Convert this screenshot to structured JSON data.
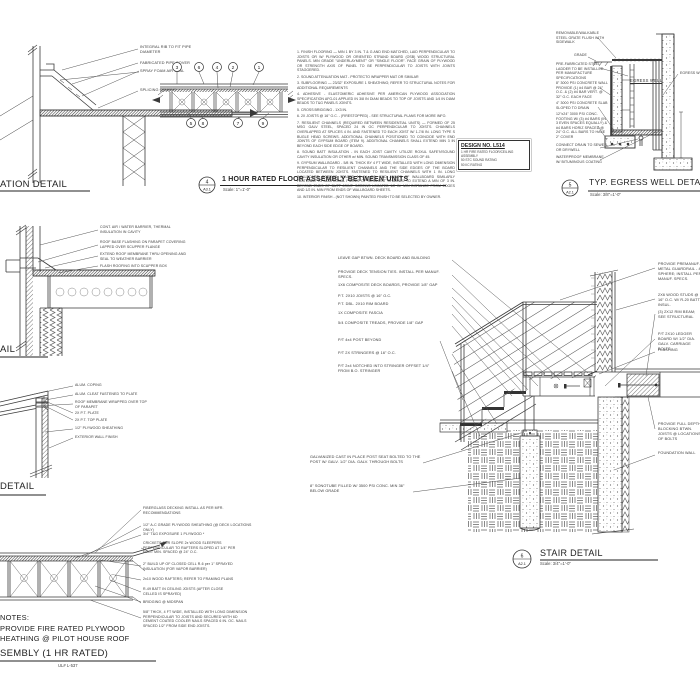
{
  "sheet": {
    "background": "#ffffff",
    "line_color": "#3a3a3a"
  },
  "details": {
    "pipe": {
      "title": "ATION DETAIL",
      "labels": [
        "INTEGRAL RIB TO FIT PIPE DIAMETER",
        "FABRICATED PIPE COVER",
        "SPRAY FOAM AIR SEAL",
        "SPLICING CEMENT"
      ]
    },
    "floor": {
      "num": "4",
      "ref": "A3.1",
      "title": "1 HOUR RATED FLOOR ASSEMBLY BETWEEN UNITS",
      "scale": "Scale: 1\"=1'-0\"",
      "callouts": [
        "3",
        "6",
        "4",
        "2",
        "1",
        "5",
        "8",
        "7",
        "9"
      ],
      "notes": [
        "1. FINISH FLOORING — MIN 1 BY 3 IN. T & G AND END MATCHED, LAID PERPENDICULAR TO JOISTS OR W/ PLYWOOD OR ORIENTED STRAND BOARD (OSB) WOOD STRUCTURAL PANELS. MIN GRADE \"UNDERLAYMENT\" OR \"SINGLE FLOOR\". FACE GRAIN OF PLYWOOD OR STRENGTH AXIS OF PANEL TO BE PERPENDICULAR TO JOISTS WITH JOINTS STAGGERED.",
        "2. SOUND ATTENUATION MAT - PROTECTO WRAPPER MAT OR SIMILAR",
        "3. SUBFLOORING — 23/32\" EXPOSURE 1 SHEATHING; REFER TO STRUCTURAL NOTES FOR ADDITIONAL REQUIREMENTS",
        "4. ADHESIVE - ELASTOMERIC ADHESIVE PER AMERICAN PLYWOOD ASSOCIATION SPECIFICATION AFG-01 APPLIED IN 3/8 IN DIAM BEADS TO TOP OF JOISTS AND 1/4 IN DIAM BEADS TO T&G PANELS JOINTS.",
        "5. CROSS BRIDGING - 1X3 IN.",
        "6. 2X JOISTS @ 16\" O.C. - (FIRESTOPPED) - SEE STRUCTURAL PLANS FOR MORE INFO.",
        "7. RESILIENT CHANNELS (REQUIRED BETWEEN RESIDENTIAL UNITS) — FORMED OF 25 MSG GALV STEEL, SPACED 24 IN OC PERPENDICULAR TO JOISTS. CHANNELS OVERLAPPED AT SPLICES 4 IN. AND FASTENED TO EACH JOIST W/ 1-7/8 IN. LONG TYPE S BUGLE HEAD SCREWS. ADDITIONAL CHANNELS POSITIONED TO COINCIDE WITH END JOINTS OF GYPSUM BOARD (ITEM 9). ADDITIONAL CHANNELS SHALL EXTEND MIN 3 IN BEYOND EACH SIDE EDGE OF BOARD.",
        "8. SOUND BATT INSULATION - IN EACH JOIST CAVITY. UTILIZE ROXUL SAFE'N'SOUND CAVITY INSULATION OR OTHER w/ MIN. SOUND TRANSMISSION CLASS OF 45.",
        "9. GYPSUM WALLBOARD - 5/8 IN. THICK BY 4 FT WIDE, INSTALLED WITH LONG DIMENSION PERPENDICULAR TO RESILIENT CHANNELS AND THE SIDE EDGES OF THE BOARD LOCATED BETWEEN JOISTS. FASTENED TO RESILIENT CHANNELS WITH 1 IN. LONG WALLBOARD SCREWS SPACED 12 IN. OC. END JOINTS OF WALLBOARD SIMILARLY FASTENED TO ADDITIONAL PIECES OF RESILIENT CHANNEL TO EXTEND A MIN OF 3 IN. BEYOND ENDS OF BUTT JOINT. SCREWS LOCATED 1/2 IN. MIN DISTANCE FROM EDGES AND 1/2 IN. MIN FROM ENDS OF WALLBOARD SHEETS.",
        "10. INTERIOR FINISH - (NOT SHOWN) PAINTED FINISH TO BE SELECTED BY OWNER."
      ],
      "design_box": {
        "title": "DESIGN NO. L514",
        "lines": [
          "1 HR FIRE RATED FLOOR/CEILING ASSEMBLY",
          "50 STC SOUND RATING",
          "50 IIC RATING"
        ]
      }
    },
    "egress": {
      "num": "5",
      "ref": "A2.1",
      "title": "TYP. EGRESS WELL DETAIL",
      "scale": "Scale: 3/8\"=1'-0\"",
      "well_label": "EGRESS WELL",
      "window_label": "EGRESS WINDOW",
      "labels": [
        "REMOVABLE/WALKABLE STEEL GRATE FLUSH WITH SIDEWALK",
        "GRADE",
        "PRE-FABRICATED STEEL LADDER TO BE INSTALLED PER MANUFACTURE SPECIFICATIONS",
        "8\" 3000 PSI CONCRETE WALL PROVIDE (1) #4 BAR @ 24\" O.C. & (2) #4 BAR VERT. @ 32\" O.C. EACH FACE",
        "4\" 3000 PSI CONCRETE SLAB SLOPED TO DRAIN",
        "12\"x24\" 3000 PSI CONC. FOOTING W/ (3) #4 BARS (IN 3 EVEN SPACES EQUALLY) & #4 BARS HORIZ SPACED @ 24\" O.C. ALL BARS TO HAVE 2\" COVER",
        "CONNECT DRAIN TO SEWER OR DRYWELL",
        "WATERPROOF MEMBRANE W/ BITUMINOUS COATING"
      ]
    },
    "scupper": {
      "title": "AIL",
      "labels": [
        "CONT. AIR / WATER BARRIER, THERMAL INSULATION IN CAVITY",
        "ROOF BASE FLASHING ON PARAPET COVERING LAPPED OVER SCUPPER FLANGE",
        "EXTEND ROOF MEMBRANE THRU OPENING AND SEAL TO WEATHER BARRIER",
        "FLASH ROOFING INTO SCUPPER BOX"
      ]
    },
    "parapet": {
      "title": "DETAIL",
      "labels": [
        "ALUM. COPING",
        "ALUM. CLEAT FASTENED TO PLATE",
        "ROOF MEMBRANE WRAPPED OVER TOP OF PARAPET",
        "2X P.T. PLATE",
        "2X P.T. TOP PLATE",
        "1/2\" PLYWOOD SHEATHING",
        "EXTERIOR WALL FINISH"
      ]
    },
    "roof": {
      "title": "SEMBLY (1 HR RATED)",
      "subtitle": "UL# L-537",
      "notes_heading": "NOTES:",
      "notes_lines": [
        "PROVIDE FIRE RATED PLYWOOD",
        "HEATHING @ PILOT HOUSE ROOF"
      ],
      "labels": [
        "FIBERGLASS DECKING INSTALL AS PER MFR. RECOMMENDATIONS",
        "1/2\" A-C GRADE PLYWOOD SHEATHING (@ DECK LOCATIONS ONLY)",
        "3/4\" T&G EXPOSURE 1 PLYWOOD *",
        "CRICKETS FOR SLOPE 2x WOOD SLEEPERS PERPENDICULAR TO RAFTERS SLOPED AT 1/4\" PER FOOT MIN. SPACED @ 24\" O.C.",
        "2\" BUILD UP OF CLOSED CELL R-6 per 1\" SPRAYED INSULATION (FOR VAPOR BARRIER)",
        "2x10 WOOD RAFTERS; REFER TO FRAMING PLANS",
        "R-49 BATT IN CEILING JOISTS (AFTER CLOSE CELLED IS SPRAYED)",
        "BRIDGING @ MIDSPAN",
        "5/8\" THICK, 4 FT WIDE, INSTALLED WITH LONG DIMENSION PERPENDICULAR TO JOISTS AND SECURED WITH 6D CEMENT COATED COOLER NAILS SPACED 6 IN. OC. NAILS SPACED 1/2\" FROM SIDE END JOISTS."
      ]
    },
    "stair": {
      "num": "6",
      "ref": "A2.1",
      "title": "STAIR DETAIL",
      "scale": "Scale: 3/4\"=1'-0\"",
      "labels_left": [
        "LEAVE GAP BTWN. DECK BOARD AND BUILDING",
        "PROVIDE DECK TENSION TIES. INSTALL PER MANUF. SPECS.",
        "1X6 COMPOSITE DECK BOARDS, PROVIDE 1/8\" GAP",
        "P.T. 2X10 JOISTS @ 16\" O.C.",
        "P.T. DBL. 2X10 RIM BOARD",
        "1X COMPOSITE FASCIA",
        "5/4 COMPOSITE TREADS, PROVIDE 1/8\" GAP",
        "P/T 4x4 POST BEYOND",
        "P/T 2X STRINGERS @ 16\" O.C.",
        "P/T 2x4 NOTCHED INTO STRINGER OFFSET 1/4\" FROM B.O. STRINGER",
        "GALVANIZED CAST IN PLACE POST SEAT BOLTED TO THE POST W/ GALV. 1/2\" DIA. GALV. THROUGH BOLTS",
        "8\" SONOTUBE FILLED W/ 3500 PSI CONC. MIN 36\" BELOW GRADE"
      ],
      "labels_right": [
        "PROVIDE PREMANUF. METAL GUARDRAIL - 4\" SPHERE; INSTALL PER MANUF. SPECS.",
        "2X6 WOOD STUDS @ 16\" O.C. W/ R-20 BATT. INSUL.",
        "(3) 2X12 RIM BEAM; SEE STRUCTURAL",
        "P/T 2X10 LEDGER BOARD W/ 1/2\" DIA. GALV. CARRIAGE BOLTS",
        "FLASHING",
        "PROVIDE FULL DEPTH BLOCKING BTWN. JOISTS @ LOCATIONS OF BOLTS",
        "FOUNDATION WALL"
      ]
    }
  }
}
